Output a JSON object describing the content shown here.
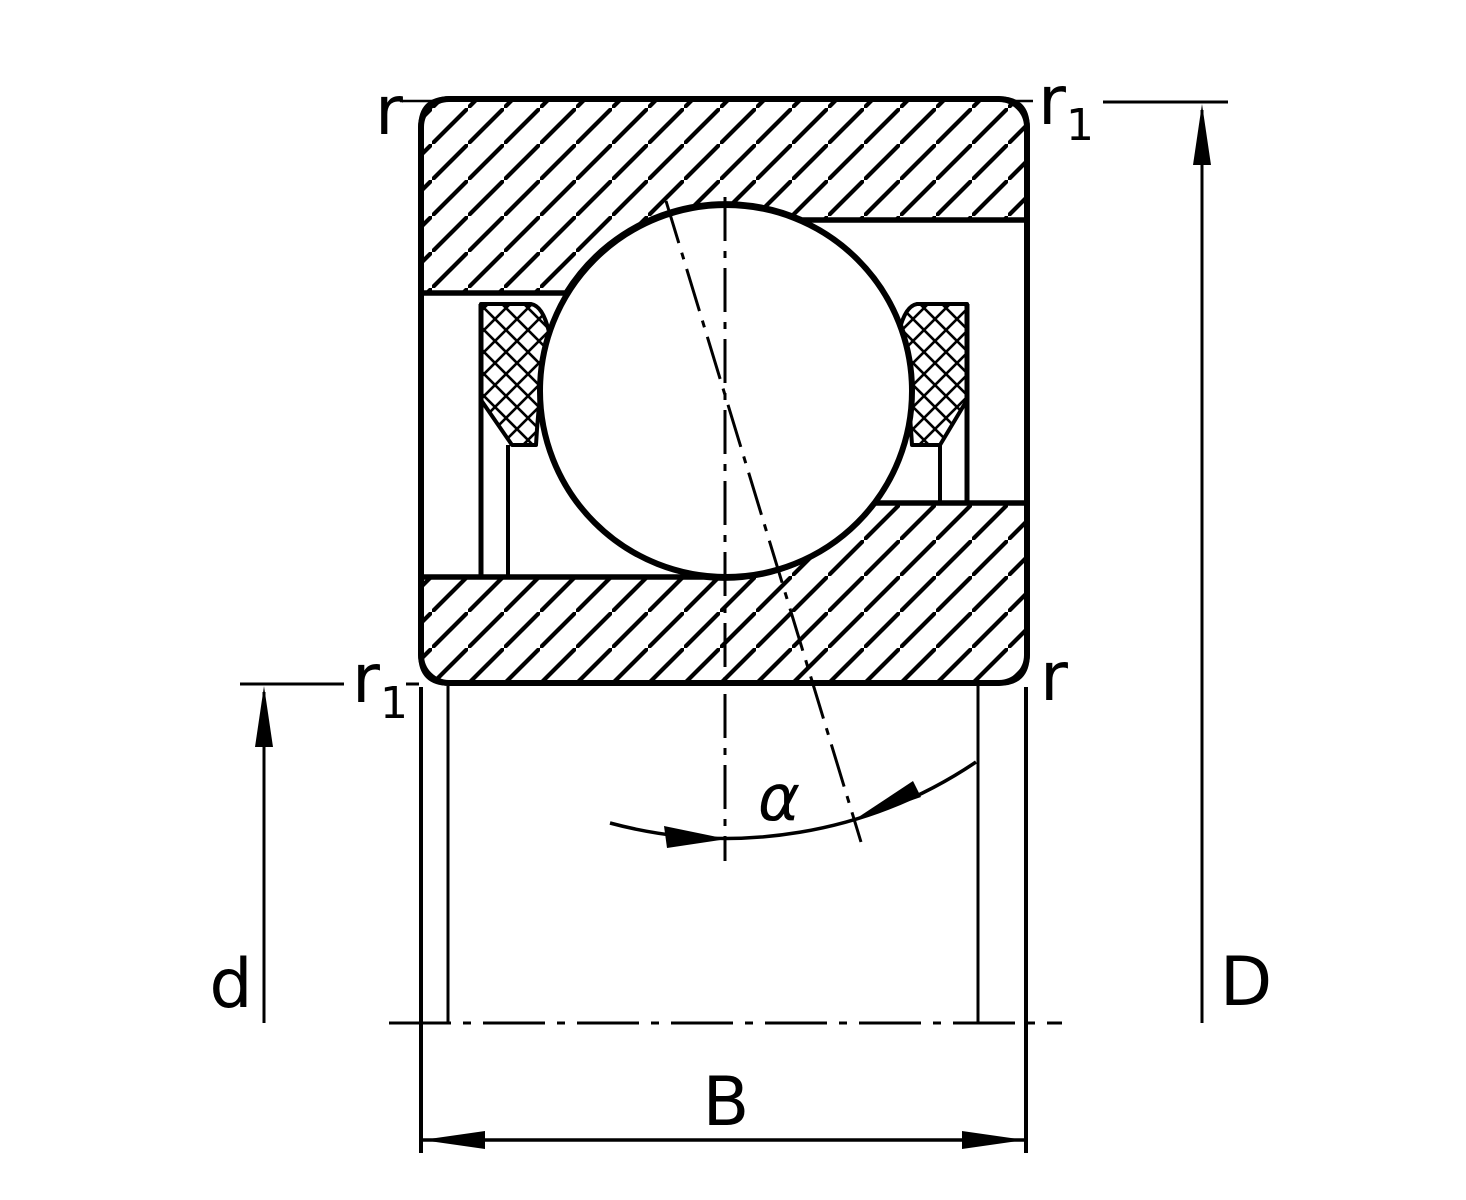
{
  "diagram": {
    "labels": {
      "chamfer_outer_top_left": "r",
      "chamfer_outer_top_right_main": "r",
      "chamfer_outer_top_right_sub": "1",
      "chamfer_inner_left_main": "r",
      "chamfer_inner_left_sub": "1",
      "chamfer_inner_right": "r",
      "bore_diameter": "d",
      "outside_diameter": "D",
      "width": "B",
      "contact_angle": "α"
    },
    "colors": {
      "line": "#000000",
      "background": "#ffffff"
    }
  }
}
